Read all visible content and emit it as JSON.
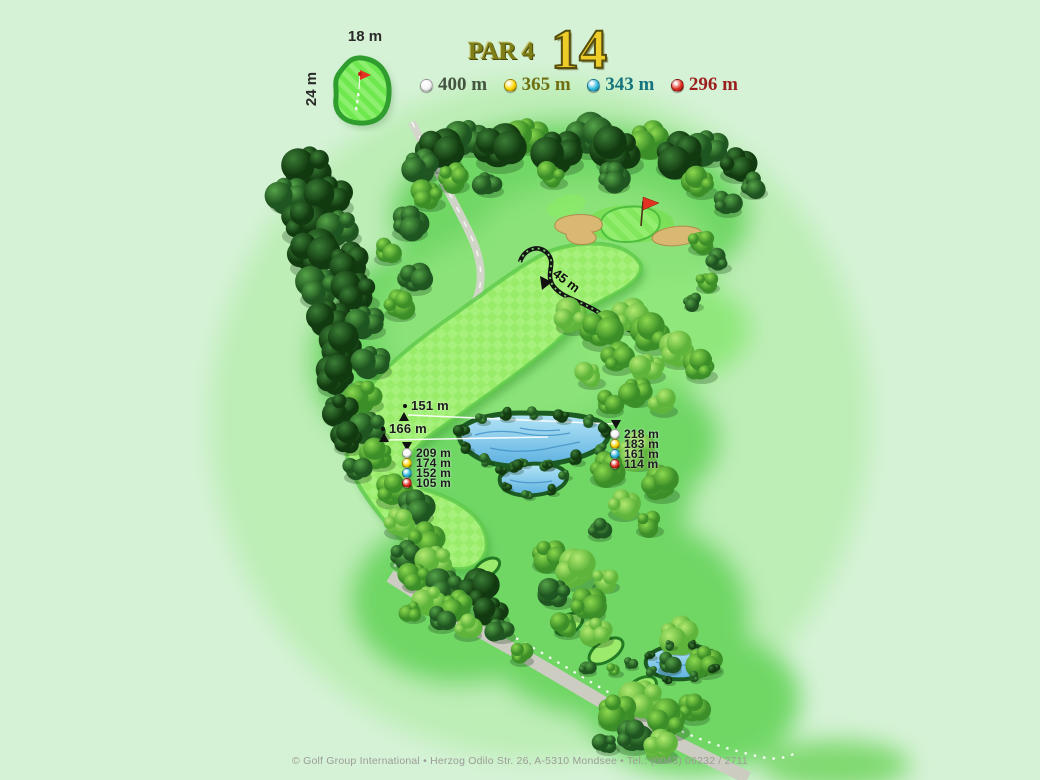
{
  "header": {
    "par_label": "PAR 4",
    "hole_number": "14"
  },
  "colors": {
    "background": "#d5f2d6",
    "par_text": "#7f7f19",
    "hole_number_fill": "#efcd28",
    "hole_number_outline": "#564e0c",
    "copyright_text": "#9c9c98"
  },
  "tee_colors": {
    "white": {
      "main": "#f4f4f4",
      "shade": "#9a9a9a"
    },
    "yellow": {
      "main": "#ffd700",
      "shade": "#8f7000"
    },
    "blue": {
      "main": "#2fb9dd",
      "shade": "#0f6a86"
    },
    "red": {
      "main": "#dd2c20",
      "shade": "#6e0f0a"
    }
  },
  "tee_legend": [
    {
      "tee": "white",
      "label": "400 m",
      "label_color": "#44543f"
    },
    {
      "tee": "yellow",
      "label": "365 m",
      "label_color": "#6f6f12"
    },
    {
      "tee": "blue",
      "label": "343 m",
      "label_color": "#14737c"
    },
    {
      "tee": "red",
      "label": "296 m",
      "label_color": "#9c1f1f"
    }
  ],
  "green_inset": {
    "width_label": "18 m",
    "depth_label": "24 m"
  },
  "distance_markers": {
    "carry_lines": [
      {
        "label": "151 m"
      },
      {
        "label": "166 m"
      }
    ],
    "left_group": [
      {
        "tee": "white",
        "label": "209 m"
      },
      {
        "tee": "yellow",
        "label": "174 m"
      },
      {
        "tee": "blue",
        "label": "152 m"
      },
      {
        "tee": "red",
        "label": "105 m"
      }
    ],
    "right_group": [
      {
        "tee": "white",
        "label": "218 m"
      },
      {
        "tee": "yellow",
        "label": "183 m"
      },
      {
        "tee": "blue",
        "label": "161 m"
      },
      {
        "tee": "red",
        "label": "114 m"
      }
    ],
    "green_path_distance": "45 m"
  },
  "footer": {
    "copyright": "© Golf Group International • Herzog Odilo Str. 26, A-5310 Mondsee • Tel.: (0043) 06232 / 2711"
  }
}
